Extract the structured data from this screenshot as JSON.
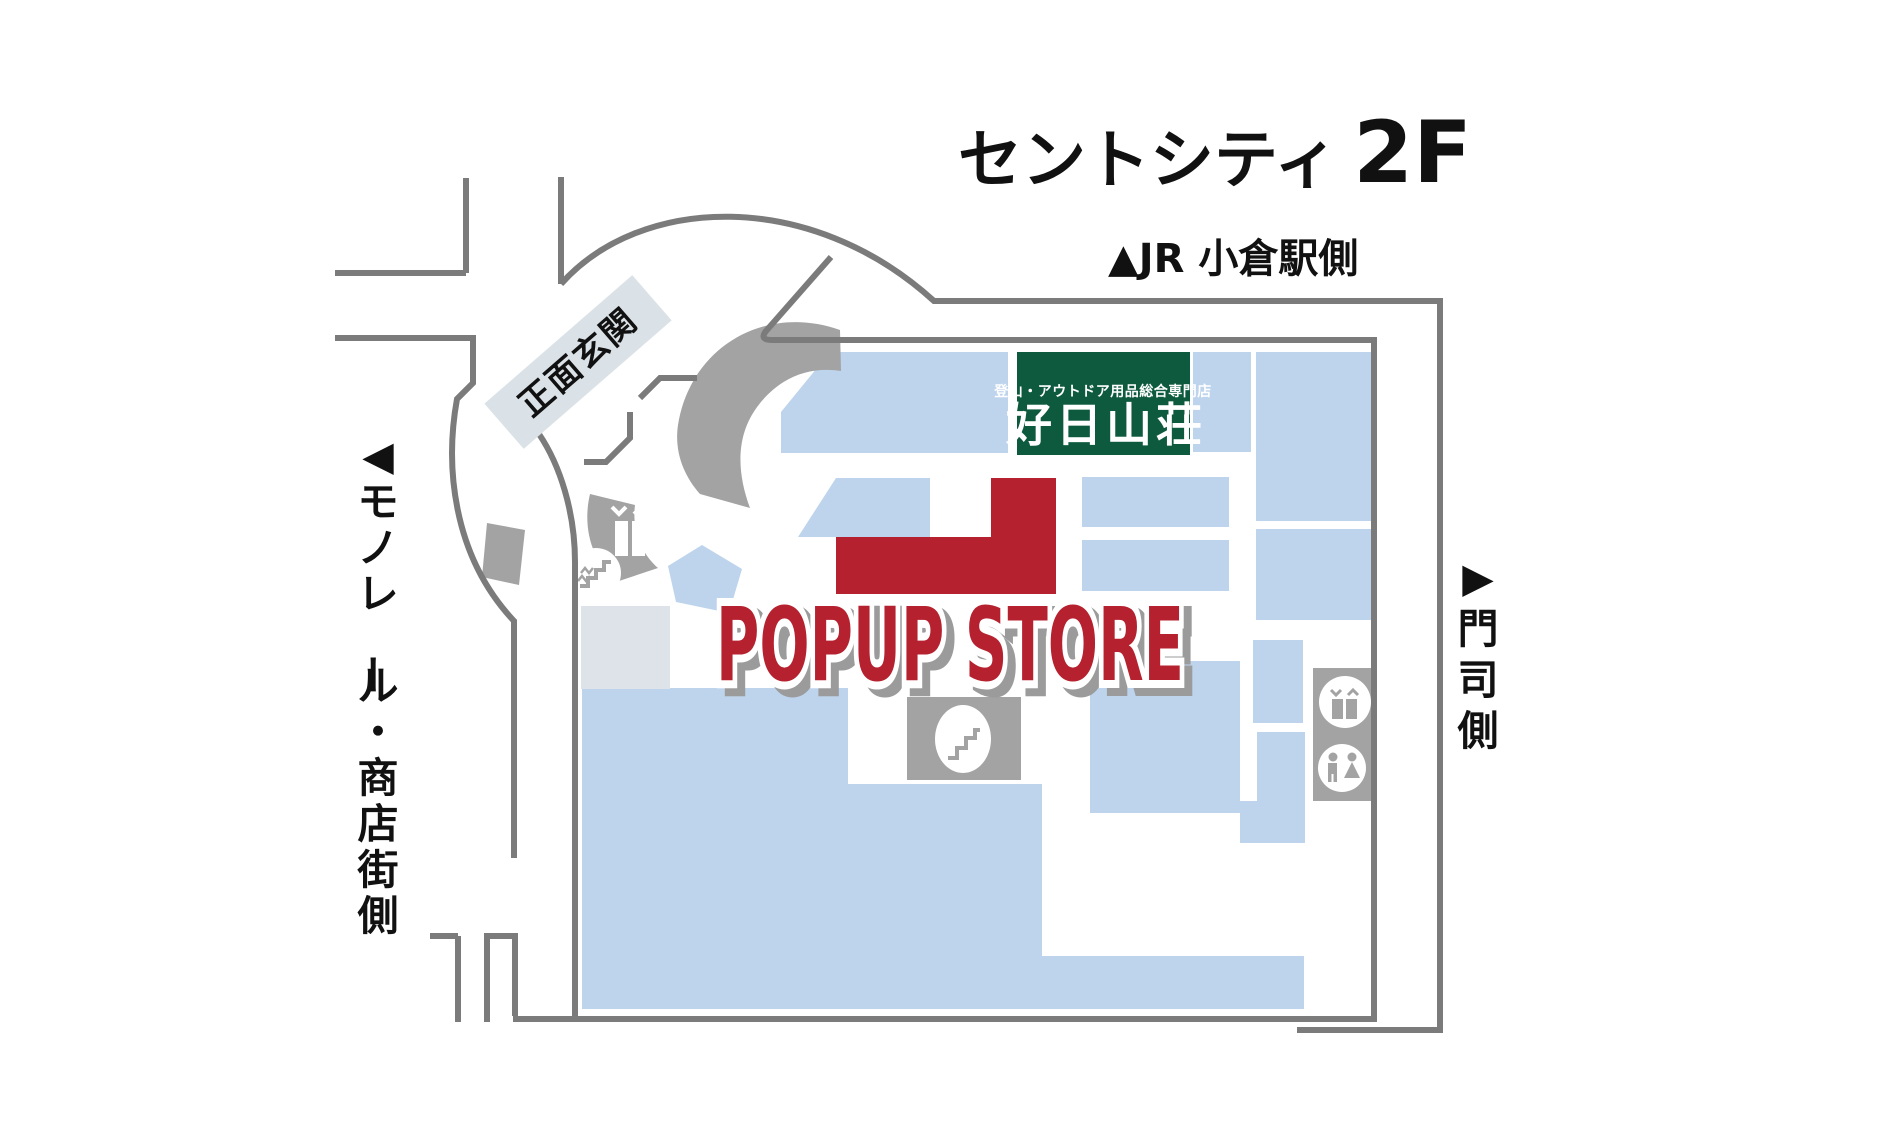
{
  "title": {
    "building": "セントシティ",
    "floor": "2F"
  },
  "directions": {
    "jr": "▲JR 小倉駅側",
    "moji": "▶門司側",
    "monorail": "◀モノレール・商店街側"
  },
  "entrance": {
    "label": "正面玄関"
  },
  "popup": {
    "label": "POPUP STORE"
  },
  "kojitsu_sign": {
    "tagline": "登山・アウトドア用品総合専門店",
    "name": "好日山荘"
  },
  "colors": {
    "accent_red": "#b5212e",
    "store_blue": "#bdd4ec",
    "sign_green": "#0d5a3e",
    "wall_gray": "#7b7b7b",
    "walkway_gray": "#a3a3a3",
    "pale_gray": "#dde3e8"
  },
  "icons": {
    "elevator": "double doors with down/up chevrons",
    "stairs": "step zigzag in white circle",
    "escalator": "diagonal steps in white oval",
    "restroom": "man and woman figures in white circle",
    "up_triangle": "▲",
    "left_triangle": "◀",
    "right_triangle": "▶"
  }
}
